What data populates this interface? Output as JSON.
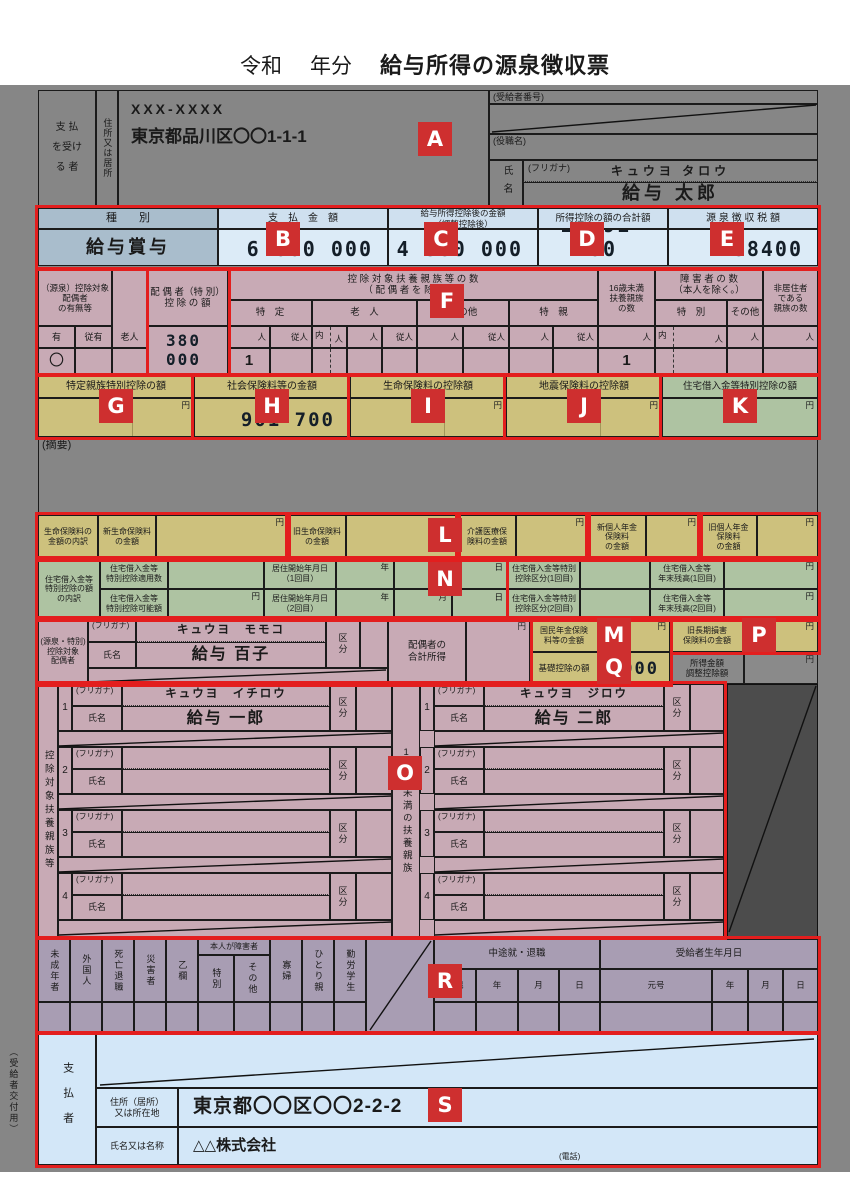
{
  "markers": {
    "a": "A",
    "b": "B",
    "c": "C",
    "d": "D",
    "e": "E",
    "f": "F",
    "g": "G",
    "h": "H",
    "i": "I",
    "j": "J",
    "k": "K",
    "l": "L",
    "m": "M",
    "n": "N",
    "o": "O",
    "p": "P",
    "q": "Q",
    "r": "R",
    "s": "S"
  },
  "glyphs": {
    "uchi": "内",
    "sen": "千",
    "yen": "円",
    "nin": "人",
    "junin": "従人",
    "nen": "年",
    "tsuki": "月",
    "hi": "日"
  },
  "title": {
    "era": "令和",
    "year": "年分",
    "main": "給与所得の源泉徴収票"
  },
  "recipient": {
    "payer_label": "支 払\nを受け\nる 者",
    "address_label": "住所又は居所",
    "postal": "XXX-XXXX",
    "address": "東京都品川区〇〇1-1-1",
    "number_label": "(受給者番号)",
    "role_label": "(役職名)",
    "name_label": "氏名",
    "furigana_label": "(フリガナ)",
    "furigana": "キュウヨ タロウ",
    "name": "給与 太郎"
  },
  "amounts": {
    "type_header": "種　　別",
    "type_value": "給与賞与",
    "payment_header": "支　払　金　額",
    "payment_value": "6 000 000",
    "after_header": "給与所得控除後の金額\n（調整控除後）",
    "after_value": "4 380 000",
    "deduction_header": "所得控除の額の合計額",
    "deduction_value": "2 591 700",
    "tax_header": "源 泉 徴 収 税 額",
    "tax_value": "88400"
  },
  "f": {
    "spouse_header": "（源泉）控除対象配偶者\nの有無等",
    "elderly": "老人",
    "yes": "有",
    "sub_yes": "従有",
    "presence": "〇",
    "spouse_special_header": "配 偶 者（特 別）\n控 除 の 額",
    "spouse_special_value": "380 000",
    "dep_header": "控 除 対 象 扶 養 親 族 等 の 数\n（ 配 偶 者 を 除 く 。）",
    "dep_cols": [
      "特　定",
      "老　人",
      "その他",
      "特　親"
    ],
    "dep_value": "1",
    "under16_header": "16歳未満\n扶養親族\nの数",
    "under16_value": "1",
    "disabled_header": "障 害 者 の 数\n（本人を除く。）",
    "disabled_cols": [
      "特　別",
      "その他"
    ],
    "nonresident_header": "非居住者\nである\n親族の数"
  },
  "row_gk": {
    "g": "特定親族特別控除の額",
    "h": "社会保険料等の金額",
    "h_value": "901 700",
    "i": "生命保険料の控除額",
    "j": "地震保険料の控除額",
    "k": "住宅借入金等特別控除の額"
  },
  "summary_label": "(摘要)",
  "life": {
    "intro": "生命保険料の\n金額の内訳",
    "labels": [
      "新生命保険料\nの金額",
      "旧生命保険料\nの金額",
      "介護医療保\n険料の金額",
      "新個人年金\n保険料\nの金額",
      "旧個人年金\n保険料\nの金額"
    ]
  },
  "housing": {
    "intro": "住宅借入金等\n特別控除の額\nの内訳",
    "r1": [
      "住宅借入金等\n特別控除適用数",
      "居住開始年月日\n（1回目）",
      "住宅借入金等特別\n控除区分(1回目)",
      "住宅借入金等\n年末残高(1回目)"
    ],
    "r2": [
      "住宅借入金等\n特別控除可能額",
      "居住開始年月日\n（2回目）",
      "住宅借入金等特別\n控除区分(2回目)",
      "住宅借入金等\n年末残高(2回目)"
    ]
  },
  "spouse": {
    "left_label": "(源泉・特別)\n控除対象\n配偶者",
    "furigana_label": "(フリガナ)",
    "name_label": "氏名",
    "furigana": "キュウヨ　モモコ",
    "name": "給与 百子",
    "kubun": "区\n分",
    "total_income_label": "配偶者の\n合計所得",
    "kokumin_label": "国民年金保険\n料等の金額",
    "kiso_label": "基礎控除の額",
    "kiso_value": ",000",
    "choki_label": "旧長期損害\n保険料の金額",
    "chosei_label": "所得金額\n調整控除額"
  },
  "dependents": {
    "left_label": "控除対象扶養親族等",
    "middle_label": "16歳未満の扶養親族",
    "furigana_label": "(フリガナ)",
    "name_label": "氏名",
    "kubun": "区\n分",
    "left_rows": [
      {
        "no": "1",
        "furigana": "キュウヨ　イチロウ",
        "name": "給与 一郎"
      },
      {
        "no": "2",
        "furigana": "",
        "name": ""
      },
      {
        "no": "3",
        "furigana": "",
        "name": ""
      },
      {
        "no": "4",
        "furigana": "",
        "name": ""
      }
    ],
    "right_rows": [
      {
        "no": "1",
        "furigana": "キュウヨ　ジロウ",
        "name": "給与 二郎"
      },
      {
        "no": "2",
        "furigana": "",
        "name": ""
      },
      {
        "no": "3",
        "furigana": "",
        "name": ""
      },
      {
        "no": "4",
        "furigana": "",
        "name": ""
      }
    ]
  },
  "flags": {
    "cols": [
      "未成年者",
      "外国人",
      "死亡退職",
      "災害者",
      "乙欄",
      "寡婦",
      "ひとり親",
      "勤労学生"
    ],
    "honnin_header": "本人が障害者",
    "honnin_cols": [
      "特別",
      "その他"
    ],
    "chuto_header": "中途就・退職",
    "chuto_cols": [
      "退職",
      "年",
      "月",
      "日"
    ],
    "birth_header": "受給者生年月日",
    "birth_cols": [
      "元号",
      "年",
      "月",
      "日"
    ]
  },
  "payer": {
    "copy_label": "（受給者交付用）",
    "payer_label": "支払者",
    "address_label": "住所（居所）\n又は所在地",
    "address": "東京都〇〇区〇〇2-2-2",
    "name_label": "氏名又は名称",
    "name": "△△株式会社",
    "tel_label": "(電話)"
  }
}
